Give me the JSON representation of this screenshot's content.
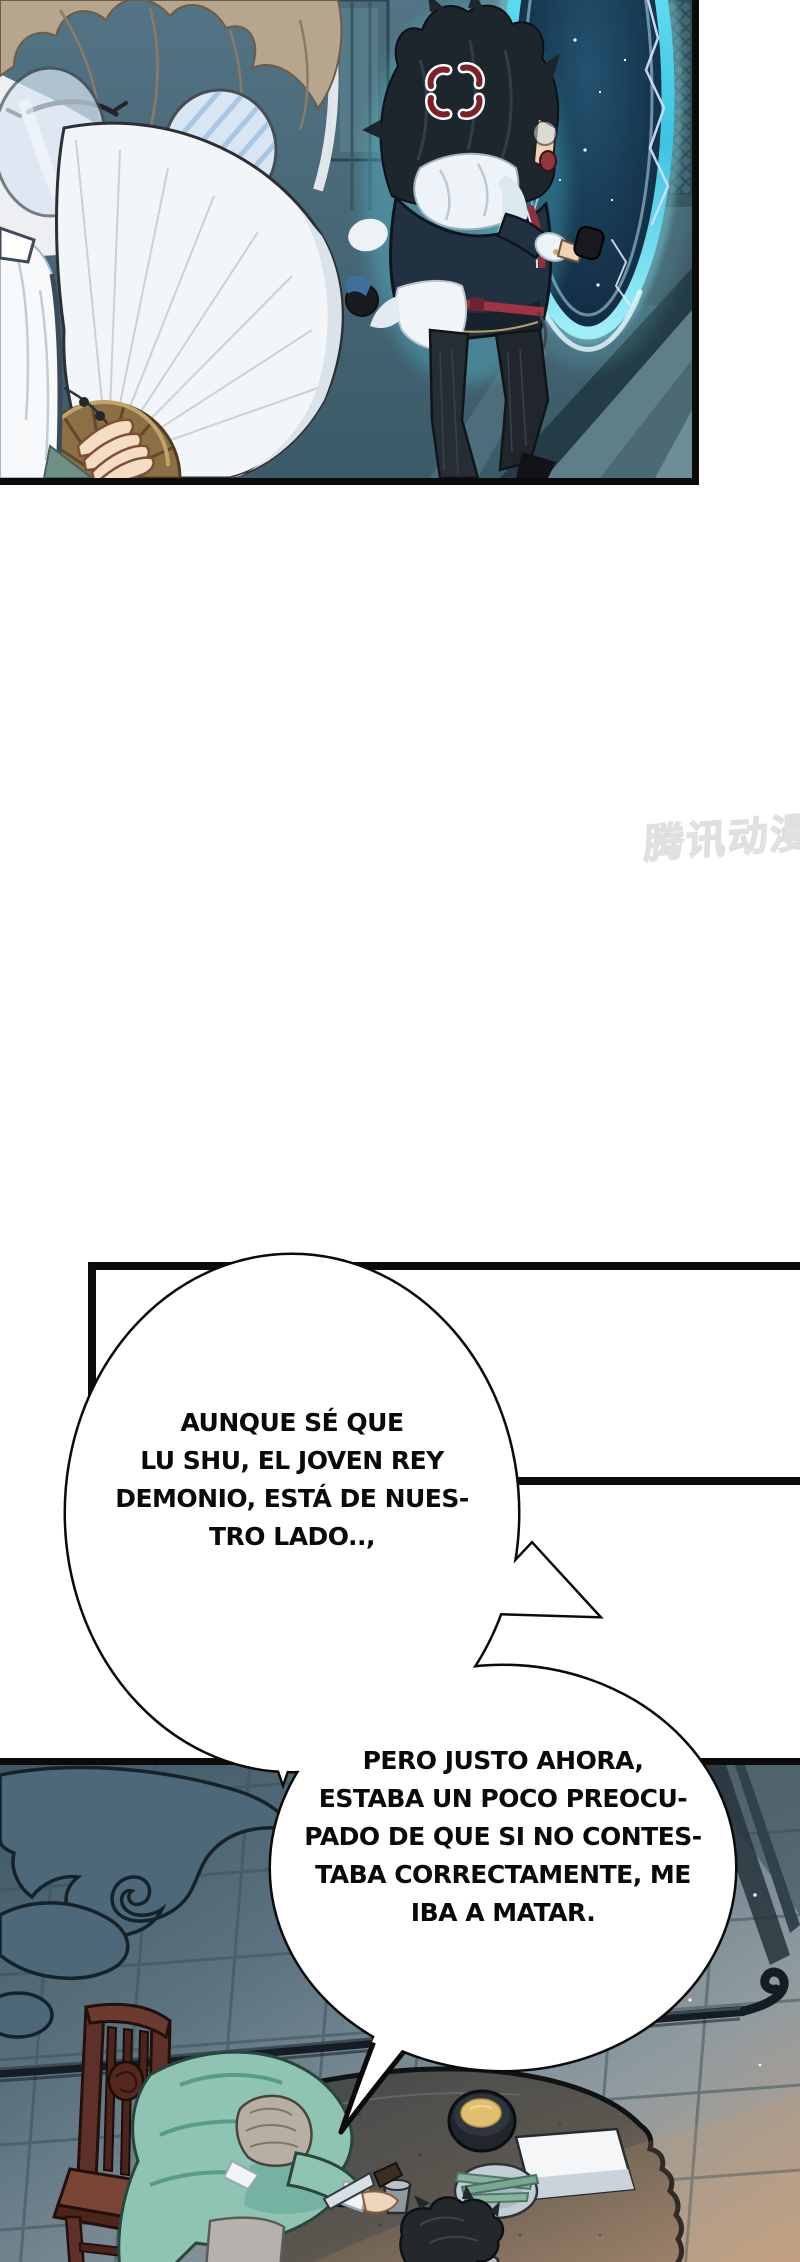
{
  "watermark": {
    "text": "腾讯动漫"
  },
  "speech": {
    "bubble1": {
      "lines": [
        "AUNQUE SÉ QUE",
        "LU SHU, EL JOVEN REY",
        "DEMONIO, ESTÁ DE NUES-",
        "TRO LADO..,"
      ]
    },
    "bubble2": {
      "lines": [
        "PERO JUSTO AHORA,",
        "ESTABA UN POCO PREOCU-",
        "PADO DE QUE SI NO CONTES-",
        "TABA CORRECTAMENTE, ME",
        "IBA A MATAR."
      ]
    }
  },
  "colors": {
    "ink": "#0a0a0a",
    "paper": "#ffffff",
    "portal_cyan": "#49cfe8",
    "glow_cyan": "#8fe9f5",
    "anger_red": "#7e1f2a",
    "belt_red": "#a23345",
    "robe_teal": "#8fc4b2",
    "tile_blue": "#5b7380",
    "cloud_slate": "#4d6878",
    "chair_brown": "#5d3029",
    "fan_gold": "#8c6f45",
    "watermark_gray": "#e0e0e0"
  }
}
